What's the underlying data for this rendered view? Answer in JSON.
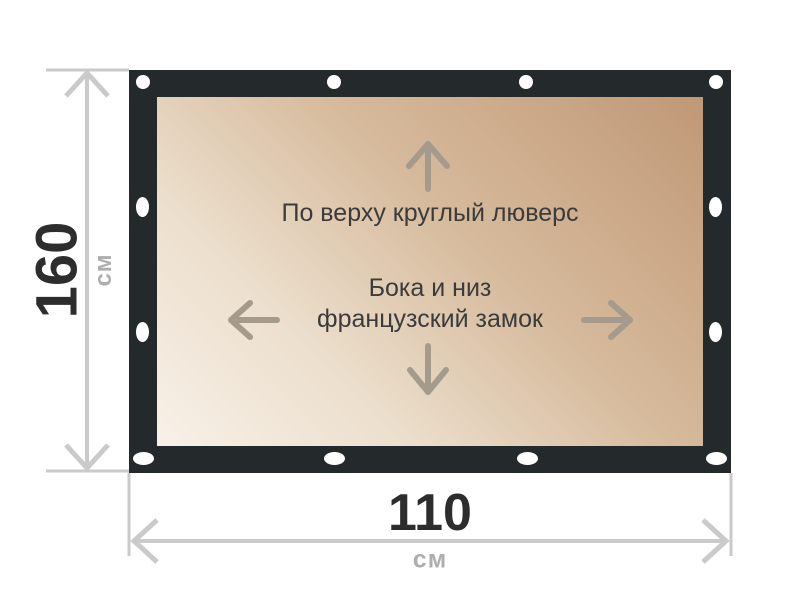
{
  "diagram": {
    "height": {
      "value": "160",
      "unit": "см"
    },
    "width": {
      "value": "110",
      "unit": "см"
    },
    "annotations": {
      "top_grommet": "По верху круглый люверс",
      "sides_line1": "Бока и низ",
      "sides_line2": "французский замок"
    },
    "icons": {
      "grommet": "grommet-icon",
      "up_arrow": "up-arrow-icon",
      "down_arrow": "down-arrow-icon",
      "left_arrow": "left-arrow-icon",
      "right_arrow": "right-arrow-icon"
    },
    "colors": {
      "frame": "#24292c",
      "tarp_light": "#f8f1e8",
      "tarp_dark": "#c09876",
      "dimension_line": "#cacaca",
      "dimension_value": "#2d2d2d",
      "dimension_unit": "#aeaeae",
      "annotation_text": "#3b3b3b",
      "direction_arrow": "#a59b8d",
      "grommet": "#ffffff"
    }
  }
}
